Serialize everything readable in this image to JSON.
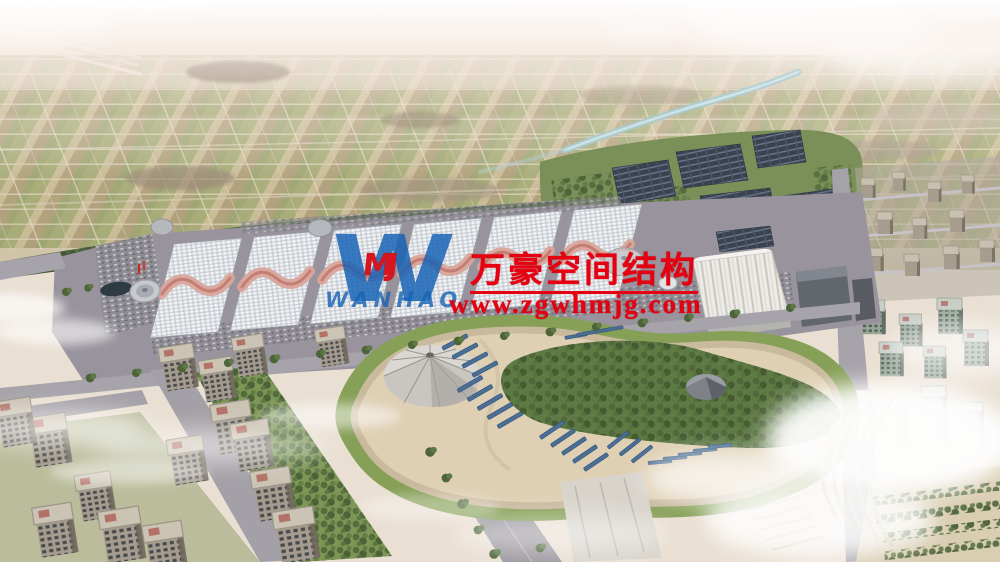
{
  "image": {
    "type": "architectural-aerial-rendering",
    "subject": "exhibition-center-complex-with-solar-farm-park-and-residential-blocks"
  },
  "watermark": {
    "logo_letter": "W",
    "logo_monogram": "MJ",
    "logo_subtext": "WANHAO",
    "company_name_cn": "万豪空间结构",
    "website": "www.zgwhmjg.com",
    "text_color": "#e60012",
    "logo_color": "#1763b6"
  },
  "palette": {
    "horizon_haze": "#f0e6dc",
    "field_green": "#98a266",
    "field_tan": "#b6ab80",
    "tree_green": "#44563a",
    "river_blue": "#a9cad0",
    "roof_white": "#eef0f2",
    "roof_crest_pink": "#d9a49a",
    "solar_panel_dark": "#3a4250",
    "park_sand": "#dfd0b4",
    "park_solar_blue": "#4b6e94",
    "road_gray": "#a7a3aa",
    "building_tan": "#998f82",
    "cloud_white": "#ffffff"
  },
  "scene": {
    "regions": [
      "distant-farmland",
      "airport-runways",
      "river",
      "solar-farm",
      "exhibition-hall-complex",
      "white-arch-hall",
      "central-park",
      "event-tent-dome",
      "park-solar-strips",
      "amphitheater",
      "residential-district-southwest",
      "residential-district-east",
      "clouds"
    ]
  }
}
